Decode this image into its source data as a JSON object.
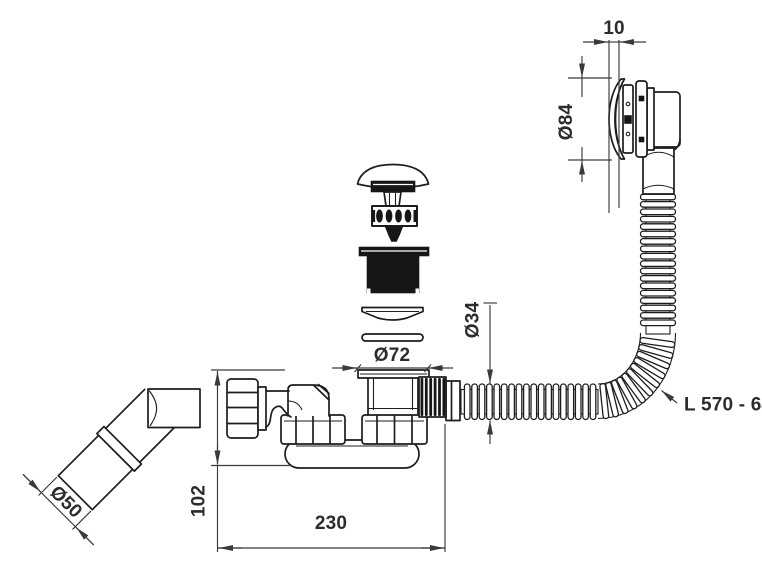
{
  "drawing": {
    "background": "#ffffff",
    "line_color": "#1d1d1b",
    "dim_color": "#3a3a38",
    "dimensions": {
      "cap_offset": "10",
      "cap_diameter": "Ø84",
      "hose_diameter": "Ø34",
      "flange_diameter": "Ø72",
      "hose_length_range": "L 570 - 640",
      "outlet_diameter": "Ø50",
      "trap_height": "102",
      "trap_width": "230"
    }
  }
}
